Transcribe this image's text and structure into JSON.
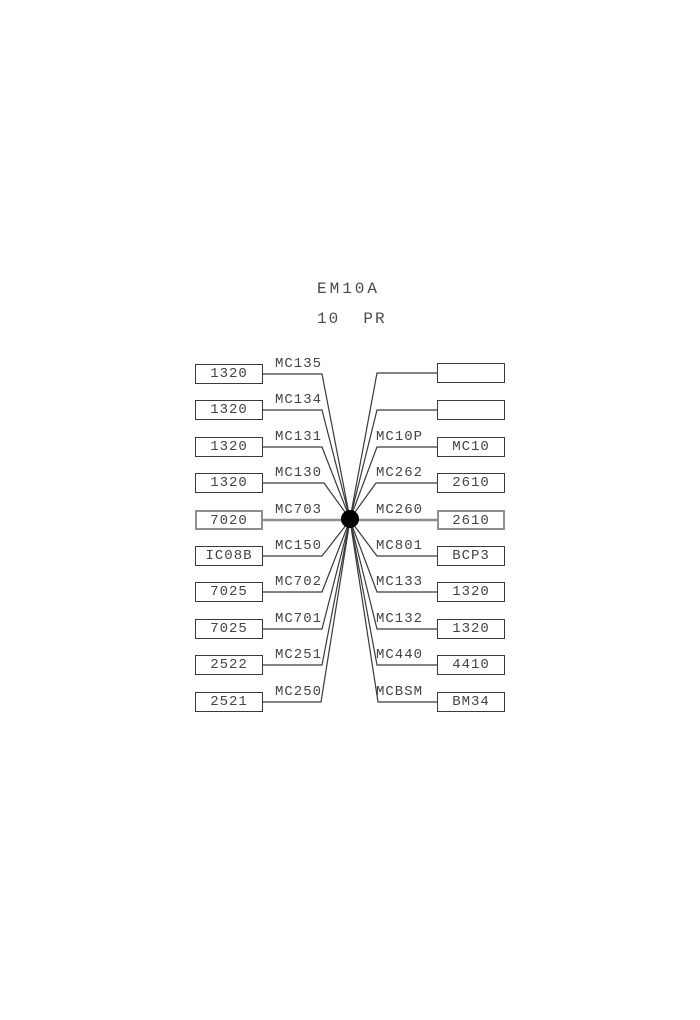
{
  "header": {
    "title": "EM10A",
    "subtitle": "10  PR"
  },
  "hub": {
    "name": "junction-dot",
    "color": "#000000"
  },
  "colors": {
    "line": "#3a3a3a",
    "through_line": "#8f8f8f",
    "box_border": "#3a3a3a",
    "text": "#444444",
    "background": "#ffffff"
  },
  "rows": [
    {
      "left_value": "1320",
      "left_label": "MC135",
      "right_label": "",
      "right_value": ""
    },
    {
      "left_value": "1320",
      "left_label": "MC134",
      "right_label": "",
      "right_value": ""
    },
    {
      "left_value": "1320",
      "left_label": "MC131",
      "right_label": "MC10P",
      "right_value": "MC10"
    },
    {
      "left_value": "1320",
      "left_label": "MC130",
      "right_label": "MC262",
      "right_value": "2610"
    },
    {
      "left_value": "7020",
      "left_label": "MC703",
      "right_label": "MC260",
      "right_value": "2610"
    },
    {
      "left_value": "IC08B",
      "left_label": "MC150",
      "right_label": "MC801",
      "right_value": "BCP3"
    },
    {
      "left_value": "7025",
      "left_label": "MC702",
      "right_label": "MC133",
      "right_value": "1320"
    },
    {
      "left_value": "7025",
      "left_label": "MC701",
      "right_label": "MC132",
      "right_value": "1320"
    },
    {
      "left_value": "2522",
      "left_label": "MC251",
      "right_label": "MC440",
      "right_value": "4410"
    },
    {
      "left_value": "2521",
      "left_label": "MC250",
      "right_label": "MCBSM",
      "right_value": "BM34"
    }
  ]
}
